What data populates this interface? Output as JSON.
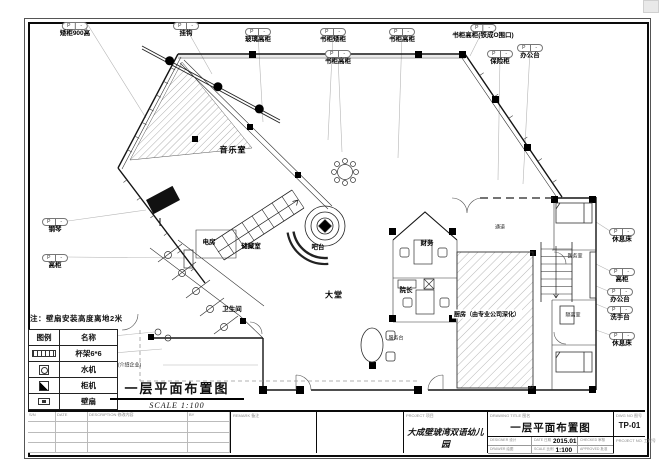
{
  "sheet": {
    "tag_left": "P",
    "tag_right": "-",
    "note": "注：壁扇安装高度离地2米",
    "legend": {
      "headers": [
        "图例",
        "名称"
      ],
      "rows": [
        {
          "symbol": "cup-rack",
          "name": "杯架6*6"
        },
        {
          "symbol": "water-dispenser",
          "name": "水机"
        },
        {
          "symbol": "cabinet-ac",
          "name": "柜机"
        },
        {
          "symbol": "wall-fan",
          "name": "壁扇"
        }
      ]
    },
    "plan_title": {
      "text": "一层平面布置图",
      "scale": "SCALE 1:100"
    },
    "callouts": [
      {
        "label": "矮柜900高",
        "x": 75,
        "y": 22
      },
      {
        "label": "挂钩",
        "x": 186,
        "y": 22
      },
      {
        "label": "玻璃高柜",
        "x": 258,
        "y": 28
      },
      {
        "label": "书柜矮柜",
        "x": 333,
        "y": 28
      },
      {
        "label": "书柜高柜",
        "x": 338,
        "y": 50
      },
      {
        "label": "书柜高柜",
        "x": 402,
        "y": 28
      },
      {
        "label": "书柜高柜(铁成O围口)",
        "x": 483,
        "y": 24
      },
      {
        "label": "保险柜",
        "x": 500,
        "y": 50
      },
      {
        "label": "办公台",
        "x": 530,
        "y": 44
      },
      {
        "label": "钢琴",
        "x": 55,
        "y": 218
      },
      {
        "label": "高柜",
        "x": 55,
        "y": 254
      },
      {
        "label": "休息床",
        "x": 622,
        "y": 228
      },
      {
        "label": "高柜",
        "x": 622,
        "y": 268
      },
      {
        "label": "办公台",
        "x": 620,
        "y": 288
      },
      {
        "label": "洗手台",
        "x": 620,
        "y": 306
      },
      {
        "label": "休息床",
        "x": 622,
        "y": 332
      },
      {
        "label": "洗手台",
        "x": 100,
        "y": 333
      },
      {
        "label": "电视机",
        "x": 100,
        "y": 350
      }
    ],
    "rooms": [
      {
        "label": "音乐室",
        "x": 233,
        "y": 150,
        "big": true
      },
      {
        "label": "电房",
        "x": 209,
        "y": 241
      },
      {
        "label": "储藏室",
        "x": 251,
        "y": 245
      },
      {
        "label": "吧台",
        "x": 318,
        "y": 246
      },
      {
        "label": "大堂",
        "x": 334,
        "y": 295,
        "big": true
      },
      {
        "label": "卫生间",
        "x": 232,
        "y": 308
      },
      {
        "label": "通道",
        "x": 500,
        "y": 227,
        "tiny": true
      },
      {
        "label": "财务",
        "x": 427,
        "y": 242
      },
      {
        "label": "院长",
        "x": 406,
        "y": 289
      },
      {
        "label": "厨房（由专业公司深化）",
        "x": 487,
        "y": 314,
        "bg": true
      },
      {
        "label": "医务室",
        "x": 575,
        "y": 256,
        "tiny": true
      },
      {
        "label": "隔离室",
        "x": 573,
        "y": 315,
        "tiny": true
      },
      {
        "label": "服务台",
        "x": 396,
        "y": 338,
        "tiny": true
      },
      {
        "label": "形象墙(介绍企业)",
        "x": 122,
        "y": 365,
        "tiny": true
      }
    ],
    "titleblock": {
      "rev_headers": [
        "S/N",
        "DATE",
        "DESCRIPTION 修改内容",
        "BY"
      ],
      "remark_label": "REMARK 备注",
      "project_label": "PROJECT 项目",
      "project": "大成壁琥湾双语幼儿园",
      "drawing_label": "DRAWING TITLE 图名",
      "drawing": "一层平面布置图",
      "designer_label": "DESIGNER 设计",
      "date_label": "DATE 日期",
      "date": "2015.01",
      "checked_label": "CHECKED 审核",
      "drawer_label": "DRAWER 绘图",
      "scale_label": "SCALE 比例",
      "scale": "1:100",
      "approved_label": "APPROVED 批准",
      "dwgno_label": "DWG NO 图号",
      "dwgno": "TP-01",
      "projectno_label": "PROJECT NO. 工程号"
    }
  }
}
